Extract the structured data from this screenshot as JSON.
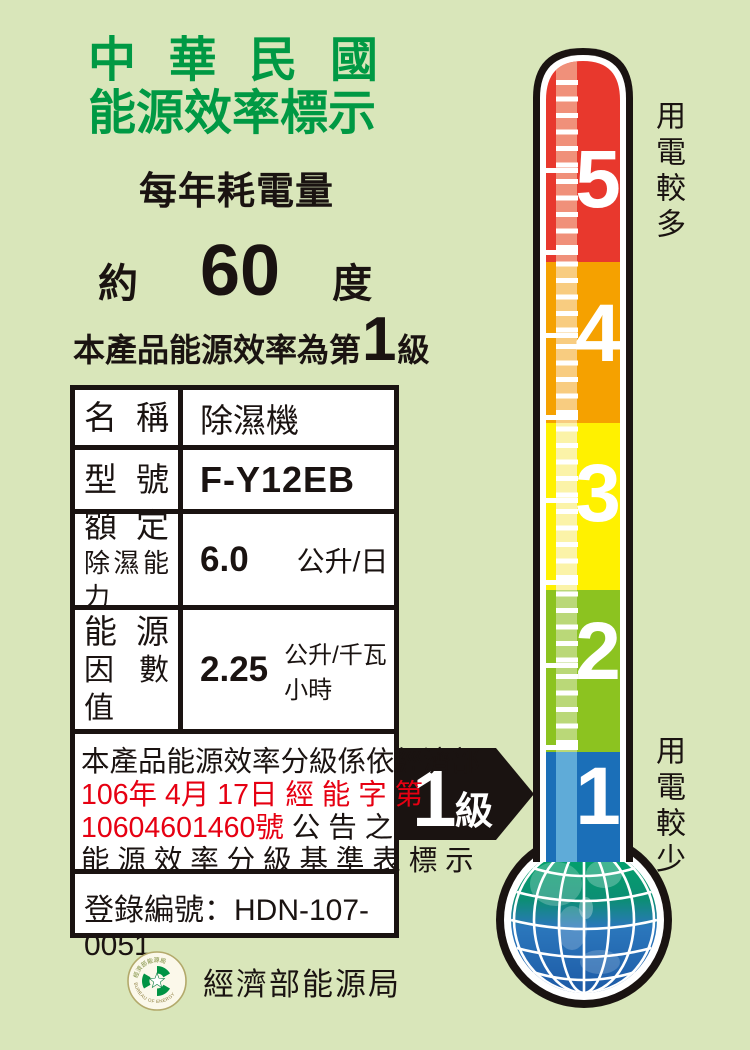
{
  "header": {
    "title_line1": "中華民國",
    "title_line2": "能源效率標示",
    "annual_heading": "每年耗電量",
    "title_color": "#009944"
  },
  "consumption": {
    "approx": "約",
    "value": "60",
    "unit": "度"
  },
  "grade_sentence": {
    "prefix": "本產品能源效率為第",
    "grade": "1",
    "suffix": "級"
  },
  "table": {
    "rows": [
      {
        "label": "名稱",
        "value": "除濕機"
      },
      {
        "label": "型號",
        "value": "F-Y12EB"
      },
      {
        "label_line1": "額定",
        "label_line2": "除濕能力",
        "value": "6.0",
        "unit": "公升/日"
      },
      {
        "label_line1": "能源",
        "label_line2": "因數值",
        "value": "2.25",
        "unit": "公升/千瓦小時"
      }
    ],
    "notice_lines": [
      {
        "black_prefix": "本產品能源效率分級係依經濟部",
        "red": "",
        "black_suffix": ""
      },
      {
        "black_prefix": "",
        "red": "106年 4月 17日 經 能 字 第",
        "black_suffix": ""
      },
      {
        "black_prefix": "",
        "red": "10604601460號",
        "black_suffix": " 公 告 之"
      },
      {
        "black_prefix": "能 源 效 率 分 級 基 準 表 標 示",
        "red": "",
        "black_suffix": ""
      }
    ],
    "registration_label": "登錄編號：",
    "registration_value": "HDN-107-0051",
    "red_color": "#E60012"
  },
  "thermometer": {
    "top_label": "用電較多",
    "bottom_label": "用電較少",
    "levels": [
      {
        "number": "5",
        "color": "#E8382D",
        "highlight": "#F0907A"
      },
      {
        "number": "4",
        "color": "#F5A100",
        "highlight": "#F8CC80"
      },
      {
        "number": "3",
        "color": "#FFF100",
        "highlight": "#FBF3A8"
      },
      {
        "number": "2",
        "color": "#8CC320",
        "highlight": "#BAD878"
      },
      {
        "number": "1",
        "color": "#1B6FB8",
        "highlight": "#5FABD8"
      }
    ],
    "arrow": {
      "grade": "1",
      "suffix": "級"
    }
  },
  "footer": {
    "agency": "經濟部能源局",
    "logo_top_text": "經濟部能源局",
    "logo_bottom_text": "BUREAU OF ENERGY"
  }
}
